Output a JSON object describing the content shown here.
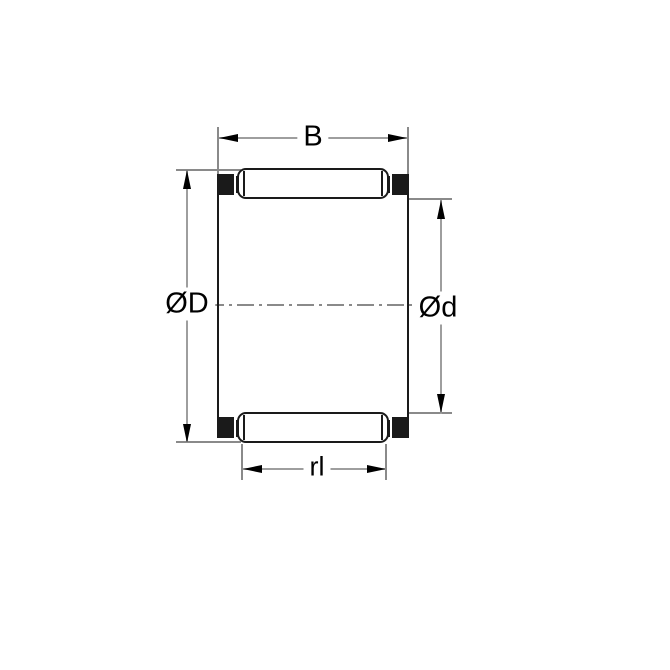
{
  "drawing": {
    "labels": {
      "width": "B",
      "outer_diameter": "ØD",
      "inner_diameter": "Ød",
      "roller_length": "rl"
    },
    "colors": {
      "background": "#ffffff",
      "outline": "#1a1a1a",
      "cage_fill": "#1a1a1a",
      "dimension_line": "#9e9e9e",
      "extension_line": "#8a8a8a",
      "centerline": "#8a8a8a",
      "arrowhead": "#000000",
      "label_text": "#000000"
    }
  }
}
